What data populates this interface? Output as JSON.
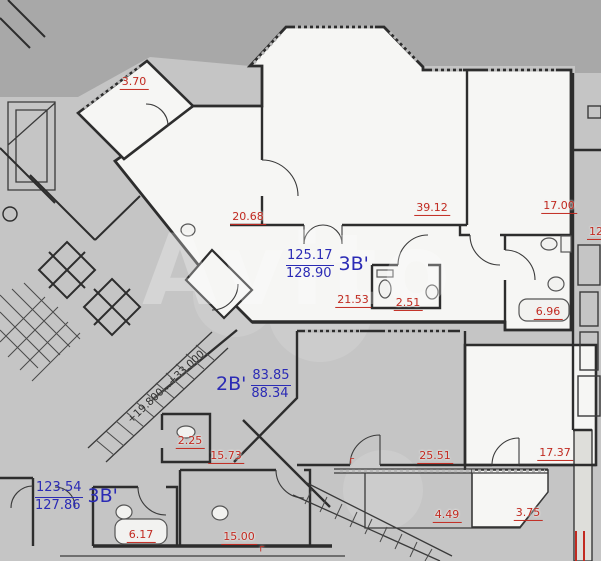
{
  "plan": {
    "watermark_text": "Avito",
    "level_mark": {
      "text": "+19.800...+33.000",
      "x": 166,
      "y": 387,
      "angle": -43
    },
    "room_areas": [
      {
        "label": "3.70",
        "x": 134,
        "y": 83
      },
      {
        "label": "20.68",
        "x": 248,
        "y": 218
      },
      {
        "label": "39.12",
        "x": 432,
        "y": 209
      },
      {
        "label": "17.00",
        "x": 559,
        "y": 207
      },
      {
        "label": "21.53",
        "x": 353,
        "y": 301
      },
      {
        "label": "2.51",
        "x": 408,
        "y": 304
      },
      {
        "label": "6.96",
        "x": 548,
        "y": 313
      },
      {
        "label": "2.25",
        "x": 190,
        "y": 442
      },
      {
        "label": "15.73",
        "x": 226,
        "y": 457
      },
      {
        "label": "25.51",
        "x": 435,
        "y": 457
      },
      {
        "label": "17.37",
        "x": 555,
        "y": 454
      },
      {
        "label": "4.49",
        "x": 447,
        "y": 516
      },
      {
        "label": "3.75",
        "x": 528,
        "y": 514
      },
      {
        "label": "15.00",
        "x": 239,
        "y": 538
      },
      {
        "label": "6.17",
        "x": 141,
        "y": 536
      },
      {
        "label": "12",
        "x": 596,
        "y": 233
      }
    ],
    "apartments": [
      {
        "type": "3В'",
        "area_living": "125.17",
        "area_total": "128.90",
        "x": 286,
        "y": 249,
        "type_side": "right"
      },
      {
        "type": "2В'",
        "area_living": "83.85",
        "area_total": "88.34",
        "x": 216,
        "y": 369,
        "type_side": "left"
      },
      {
        "type": "3В'",
        "area_living": "123.54",
        "area_total": "127.86",
        "x": 35,
        "y": 481,
        "type_side": "right"
      }
    ],
    "balcony_marks": [
      {
        "label": "г",
        "x": 352,
        "y": 461
      },
      {
        "label": "г",
        "x": 262,
        "y": 549
      }
    ],
    "colors": {
      "background": "#a8a8a8",
      "building": "#c5c5c5",
      "room_fill": "#f6f6f4",
      "wall": "#2d2d2d",
      "area_text": "#c22a21",
      "apartment_text": "#2b2bb5",
      "fixture": "#555555"
    }
  }
}
